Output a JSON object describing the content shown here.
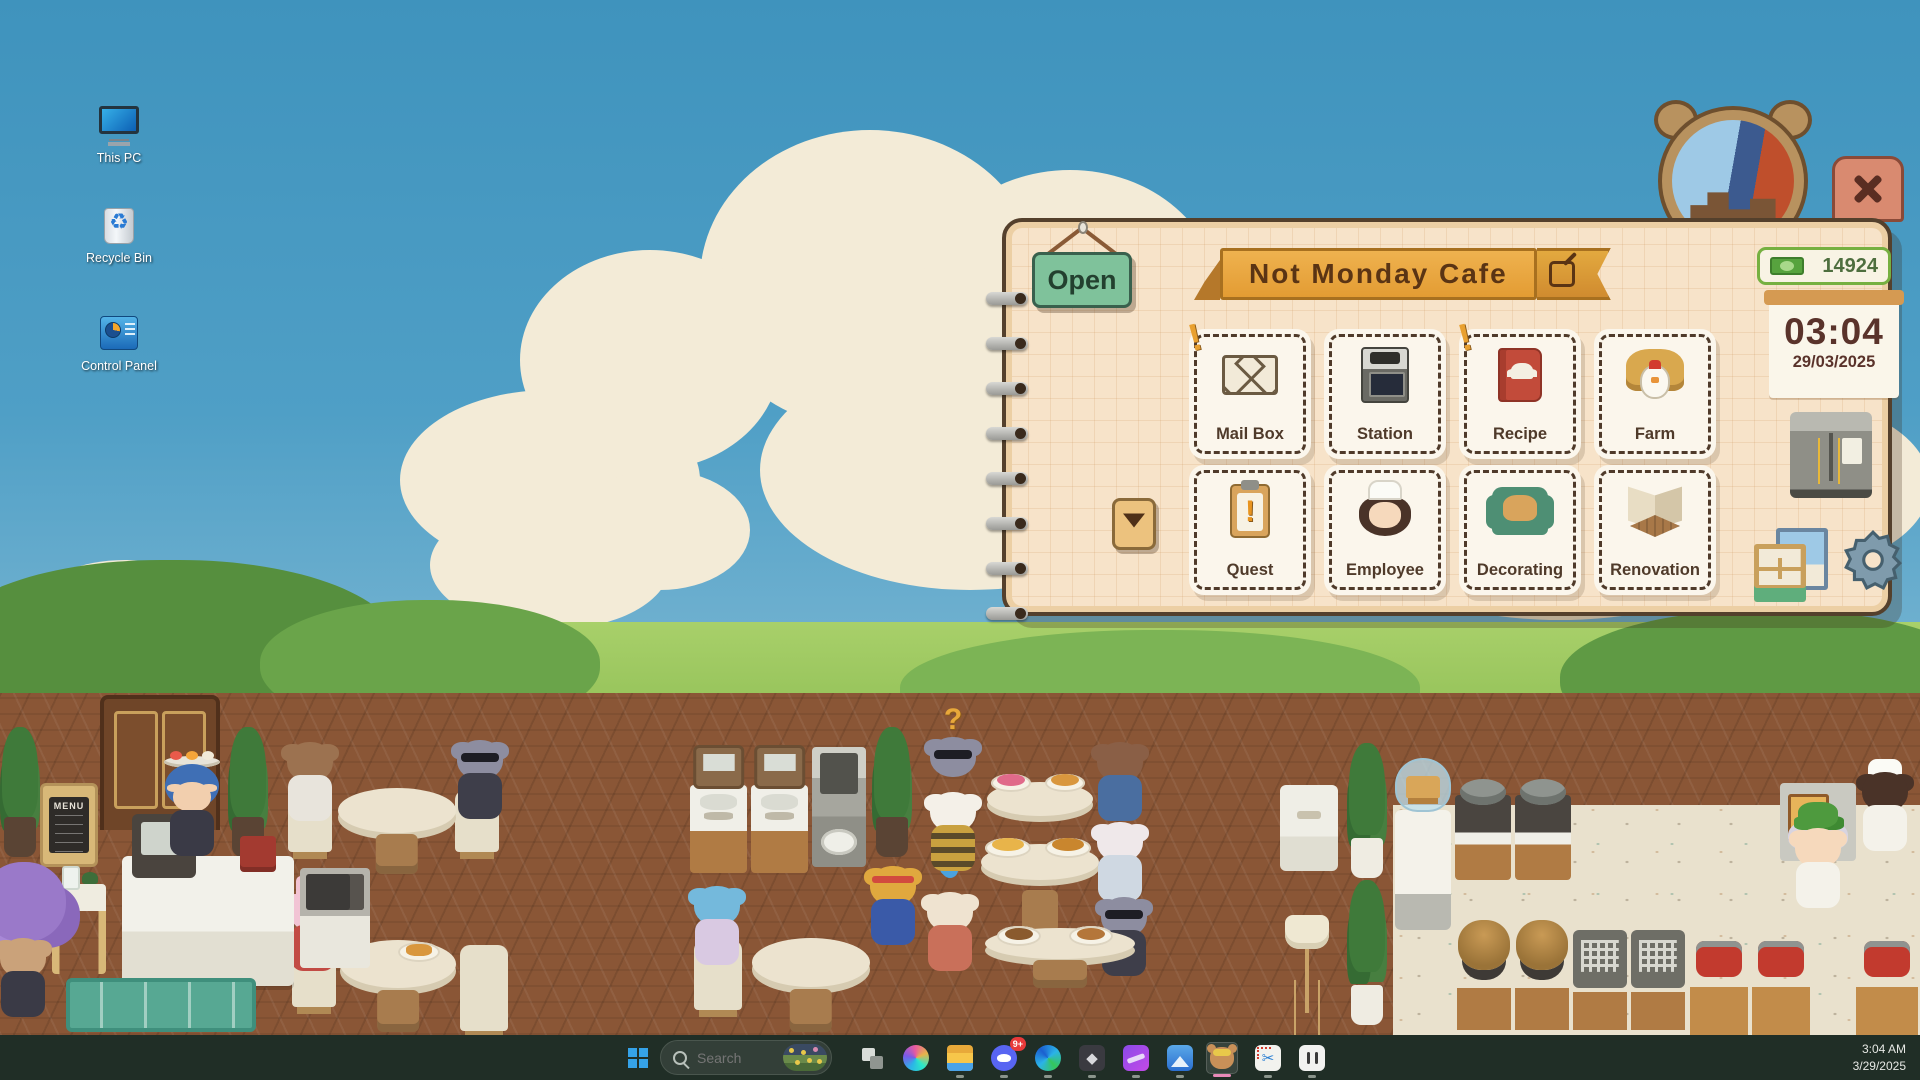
{
  "desktop": {
    "icons": [
      {
        "label": "This PC"
      },
      {
        "label": "Recycle Bin"
      },
      {
        "label": "Control Panel"
      }
    ]
  },
  "game": {
    "scene": {
      "menu_sign": "MENU"
    },
    "panel": {
      "status_sign": "Open",
      "cafe_name": "Not Monday Cafe",
      "money": "14924",
      "alert_glyph": "!",
      "clock": {
        "time": "03:04",
        "date": "29/03/2025"
      },
      "stamps": [
        {
          "label": "Mail Box",
          "alert": true
        },
        {
          "label": "Station",
          "alert": false
        },
        {
          "label": "Recipe",
          "alert": true
        },
        {
          "label": "Farm",
          "alert": false
        },
        {
          "label": "Quest",
          "alert": false
        },
        {
          "label": "Employee",
          "alert": false
        },
        {
          "label": "Decorating",
          "alert": false
        },
        {
          "label": "Renovation",
          "alert": false
        }
      ],
      "colors": {
        "panel_bg": "#f7e3c9",
        "banner_orange": "#e8a33d",
        "sign_green": "#7fc29b",
        "money_green": "#76b041",
        "text_brown": "#4f3a2a",
        "close_salmon": "#d98a70"
      }
    }
  },
  "taskbar": {
    "search_placeholder": "Search",
    "discord_badge": "9+",
    "clock": {
      "time": "3:04 AM",
      "date": "3/29/2025"
    }
  }
}
